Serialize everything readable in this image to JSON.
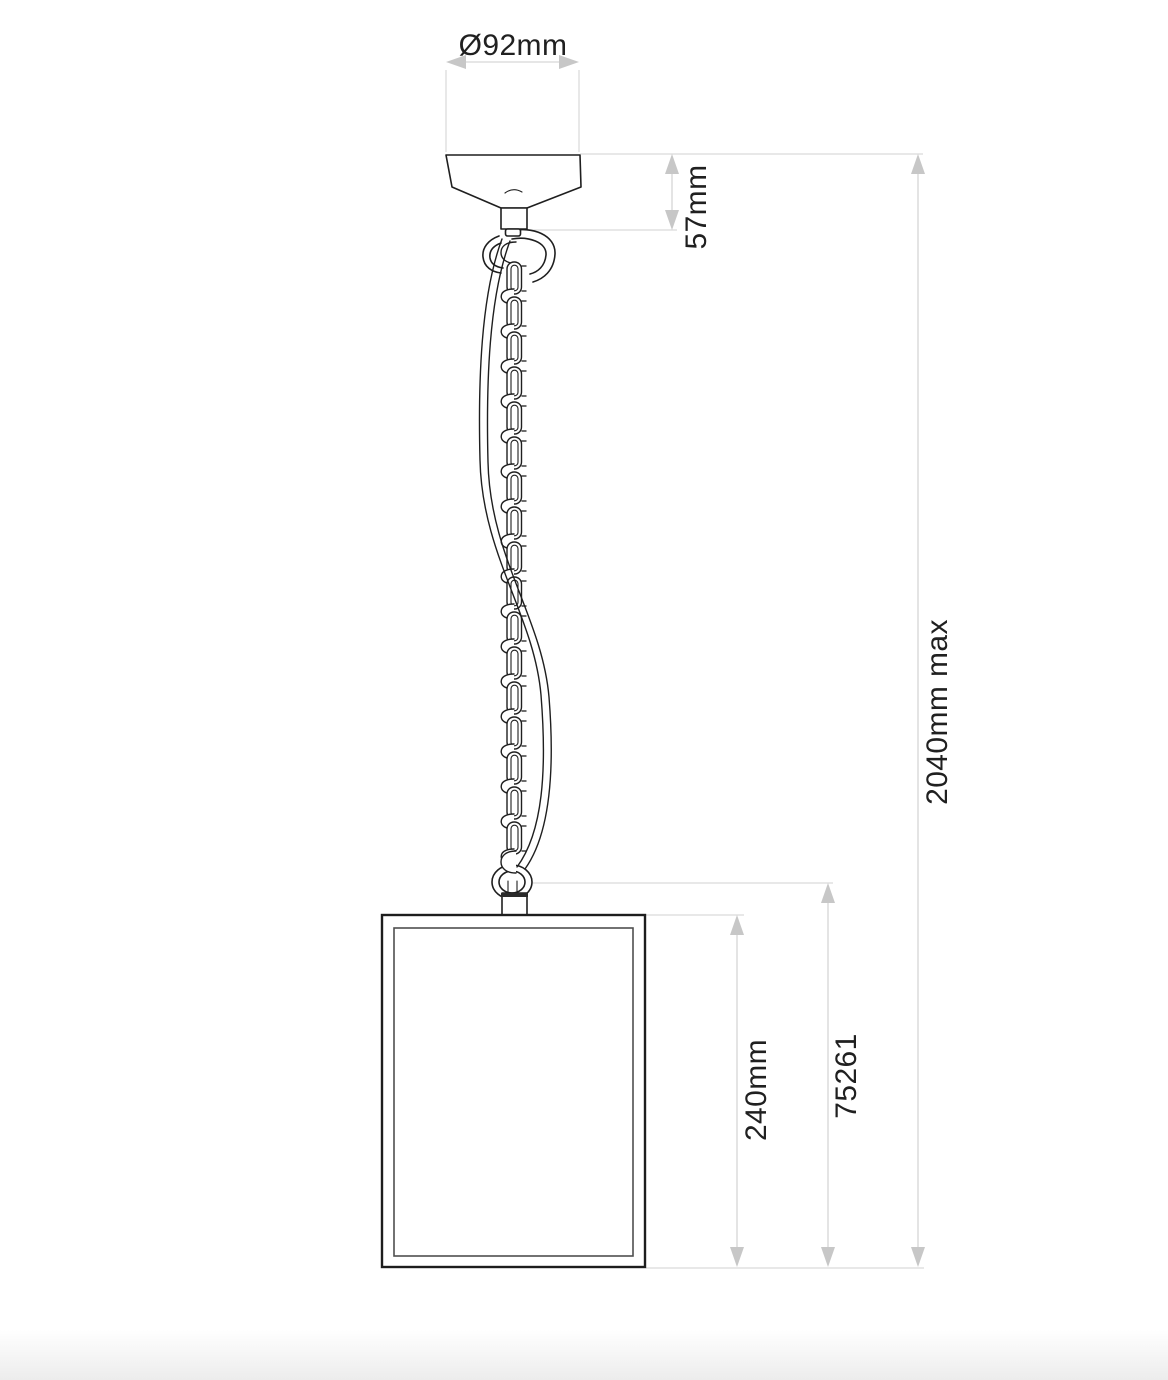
{
  "dimensions": {
    "canopy_diameter": "Ø92mm",
    "canopy_height": "57mm",
    "shade_height": "240mm",
    "product_code": "75261",
    "max_drop": "2040mm max"
  },
  "colors": {
    "drawing_line": "#1f1f1f",
    "dimension_line": "#d6d6d6",
    "arrowhead": "#c7c7c7",
    "label_text": "#202020",
    "background": "#ffffff"
  }
}
